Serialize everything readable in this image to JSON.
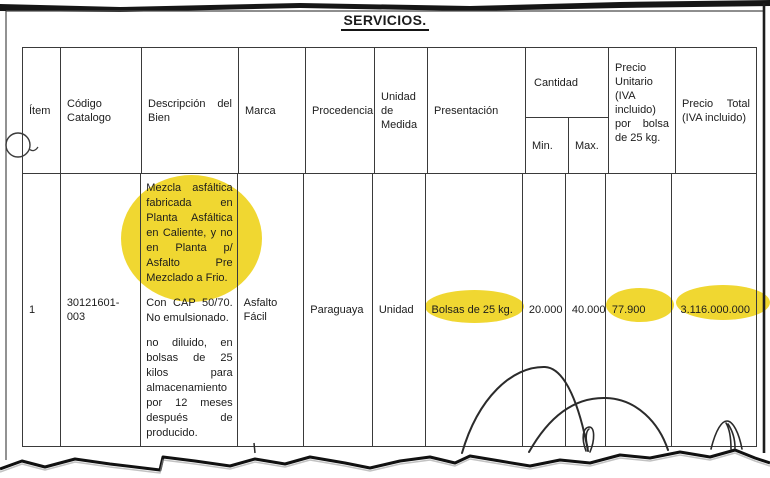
{
  "page": {
    "title": "SERVICIOS."
  },
  "colors": {
    "highlight": "#f0d731",
    "ink": "#1c1c1c",
    "table_line": "#3a3a3a",
    "pen": "#2b2b2b",
    "scan_edge": "#161616"
  },
  "table": {
    "headers": {
      "item": "Ítem",
      "codigo": "Código Catalogo",
      "descripcion": "Descripción del Bien",
      "marca": "Marca",
      "procedencia": "Procedencia",
      "unidad_medida": "Unidad de Medida",
      "presentacion": "Presentación",
      "cantidad": "Cantidad",
      "cantidad_min": "Min.",
      "cantidad_max": "Max.",
      "precio_unitario": "Precio Unitario (IVA incluido) por bolsa de 25 kg.",
      "precio_total": "Precio Total (IVA incluido)"
    },
    "rows": [
      {
        "item": "1",
        "codigo": "30121601-003",
        "descripcion_resaltada": "Mezcla asfáltica fabricada en Planta Asfáltica en Caliente, y no en Planta p/ Asfalto Pre Mezclado a Frio.",
        "descripcion_cap": "Con CAP 50/70. No emulsionado.",
        "descripcion_almacenamiento": "no diluido, en bolsas de 25 kilos para almacenamiento por 12 meses después de producido.",
        "marca": "Asfalto Fácil",
        "procedencia": "Paraguaya",
        "unidad_medida": "Unidad",
        "presentacion": "Bolsas de 25 kg.",
        "cantidad_min": "20.000",
        "cantidad_max": "40.000",
        "precio_unitario": "77.900",
        "precio_total": "3.116.000.000"
      }
    ]
  },
  "annotations": {
    "highlighted_fields": [
      "descripcion_resaltada",
      "presentacion",
      "precio_unitario",
      "precio_total"
    ],
    "pen_marks": "hand-drawn arcs and loops at bottom of table, circle mark on left border",
    "paper": "torn bottom edge, dark scanner edge at top and right"
  }
}
